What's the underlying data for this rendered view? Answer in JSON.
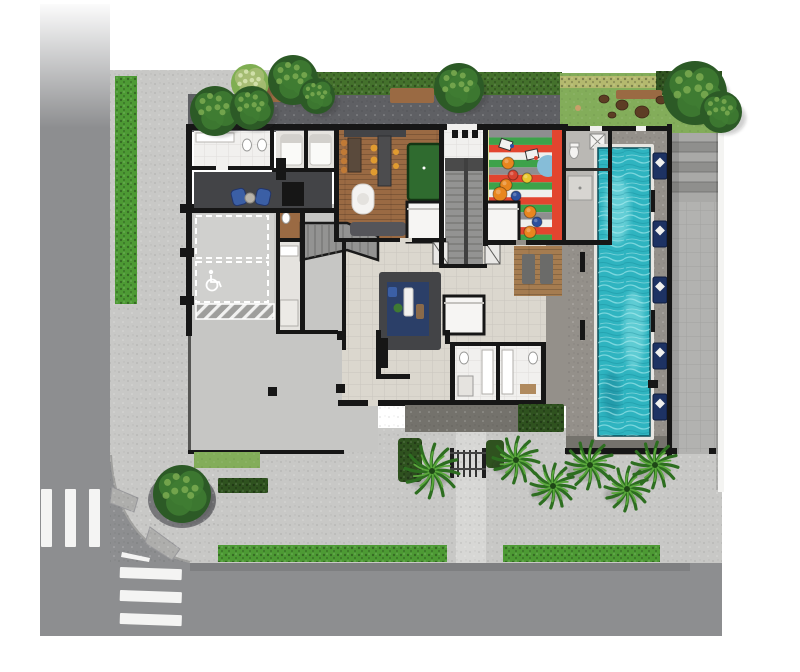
{
  "scene": {
    "type": "architectural-site-plan",
    "description": "Top-down implantation plan of a residential building ground floor with street corner, sidewalks, parking, lobby, party room, kids playroom, lap pool with deck loungers and landscaped gardens",
    "visible_text": []
  },
  "colors": {
    "road": "#8d8e90",
    "crosswalk": "#f4f4f3",
    "sidewalk": "#c8c8c6",
    "terrace": "#b2b2b0",
    "walkway": "#5f6064",
    "entry_path": "#d7d7d5",
    "ramp": "#aeaeac",
    "hedge": "#44712c",
    "hedge_bright": "#4d9a34",
    "hedge_dark": "#2f521f",
    "hedge_yellow": "#b4b96e",
    "lawn": "#83ad5a",
    "mulch": "#5d3d24",
    "gravel": "#75757a",
    "tree_dark": "#2c5a26",
    "tree_mid": "#3f7c33",
    "tree_light": "#7fae52",
    "tree_pale": "#a8bd76",
    "palm_dark": "#2d6e20",
    "palm_light": "#5aa83c",
    "wall": "#161616",
    "floor_white": "#f1f0ee",
    "floor_spa": "#e5e3df",
    "floor_beige": "#dbd7ce",
    "concrete": "#c6c6c4",
    "concrete_light": "#d0d0ce",
    "charcoal": "#434447",
    "stair": "#939392",
    "stair_dark": "#4a4a4a",
    "wood": "#9a6a43",
    "wood_deck": "#a57c50",
    "pool_deck": "#94908a",
    "dark_paving": "#74726c",
    "changing_floor": "#bab8b4",
    "water": "#2fb4c0",
    "water_light": "#9ae9ec",
    "play_green": "#3da24a",
    "play_red": "#e2452f",
    "play_white": "#efefec",
    "play_gray": "#8e8e90",
    "play_yellow": "#dde29b",
    "play_blue": "#86bdd8",
    "pouf_orange": "#e8861f",
    "pouf_blue": "#2c4f9e",
    "pouf_red": "#d84330",
    "pouf_rainbow": "#e8c52c",
    "rug_navy": "#2b3f68",
    "lounger": "#1d3263",
    "pillow": "#f0f0ee",
    "chair_blue": "#3b5fa5",
    "billiard": "#2f6b2f"
  },
  "collections": {
    "crosswalk_vertical": {
      "x0": 41,
      "y": 489,
      "bar_w": 11,
      "bar_h": 58,
      "gap": 13,
      "count": 3
    },
    "crosswalk_horizontal": {
      "x": 120,
      "w": 62,
      "y0": 567,
      "bar_h": 11,
      "gap": 12,
      "count": 3
    },
    "terrace_steps": {
      "x": 672,
      "w": 46,
      "y0": 132,
      "step_h": 10,
      "count": 7
    },
    "pool": {
      "x": 598,
      "y": 148,
      "w": 52,
      "h": 288
    },
    "loungers": {
      "x": 653,
      "w": 14,
      "h": 26,
      "ys": [
        153,
        221,
        277,
        343,
        394
      ]
    },
    "play_stripes": {
      "x": 489,
      "y0": 130,
      "w": 63,
      "stripe_h": 7.47,
      "sequence": [
        "play_gray",
        "play_green",
        "play_red",
        "play_white",
        "play_green",
        "play_gray",
        "play_red",
        "play_green",
        "play_white",
        "play_red",
        "play_green",
        "play_gray",
        "play_white",
        "play_red",
        "play_green"
      ]
    },
    "poufs": [
      {
        "x": 508,
        "y": 163,
        "r": 6,
        "c": "pouf_orange"
      },
      {
        "x": 513,
        "y": 175,
        "r": 5,
        "c": "pouf_red"
      },
      {
        "x": 506,
        "y": 185,
        "r": 6,
        "c": "pouf_orange"
      },
      {
        "x": 527,
        "y": 178,
        "r": 5,
        "c": "pouf_rainbow"
      },
      {
        "x": 500,
        "y": 194,
        "r": 7,
        "c": "pouf_orange"
      },
      {
        "x": 516,
        "y": 196,
        "r": 5,
        "c": "pouf_blue"
      },
      {
        "x": 530,
        "y": 212,
        "r": 6,
        "c": "pouf_orange"
      },
      {
        "x": 537,
        "y": 222,
        "r": 5,
        "c": "pouf_blue"
      },
      {
        "x": 530,
        "y": 232,
        "r": 6,
        "c": "pouf_orange"
      }
    ],
    "trees": [
      {
        "x": 250,
        "y": 83,
        "r": 19,
        "variant": "light"
      },
      {
        "x": 215,
        "y": 111,
        "r": 25,
        "variant": "dark"
      },
      {
        "x": 252,
        "y": 108,
        "r": 22,
        "variant": "dark"
      },
      {
        "x": 293,
        "y": 80,
        "r": 25,
        "variant": "dark"
      },
      {
        "x": 317,
        "y": 96,
        "r": 18,
        "variant": "dark"
      },
      {
        "x": 459,
        "y": 88,
        "r": 25,
        "variant": "dark"
      },
      {
        "x": 695,
        "y": 93,
        "r": 32,
        "variant": "dark"
      },
      {
        "x": 721,
        "y": 112,
        "r": 21,
        "variant": "dark"
      },
      {
        "x": 182,
        "y": 494,
        "r": 29,
        "variant": "dark"
      }
    ],
    "palms": [
      {
        "x": 432,
        "y": 471,
        "r": 27
      },
      {
        "x": 516,
        "y": 460,
        "r": 23
      },
      {
        "x": 553,
        "y": 486,
        "r": 22
      },
      {
        "x": 590,
        "y": 465,
        "r": 24
      },
      {
        "x": 627,
        "y": 489,
        "r": 22
      },
      {
        "x": 655,
        "y": 465,
        "r": 23
      }
    ],
    "mulch": [
      {
        "x": 604,
        "y": 99,
        "r": 4
      },
      {
        "x": 622,
        "y": 105,
        "r": 5
      },
      {
        "x": 642,
        "y": 112,
        "r": 6
      },
      {
        "x": 661,
        "y": 100,
        "r": 4
      },
      {
        "x": 612,
        "y": 115,
        "r": 3
      }
    ],
    "columns": [
      [
        337,
        331
      ],
      [
        336,
        384
      ],
      [
        268,
        387
      ]
    ]
  }
}
